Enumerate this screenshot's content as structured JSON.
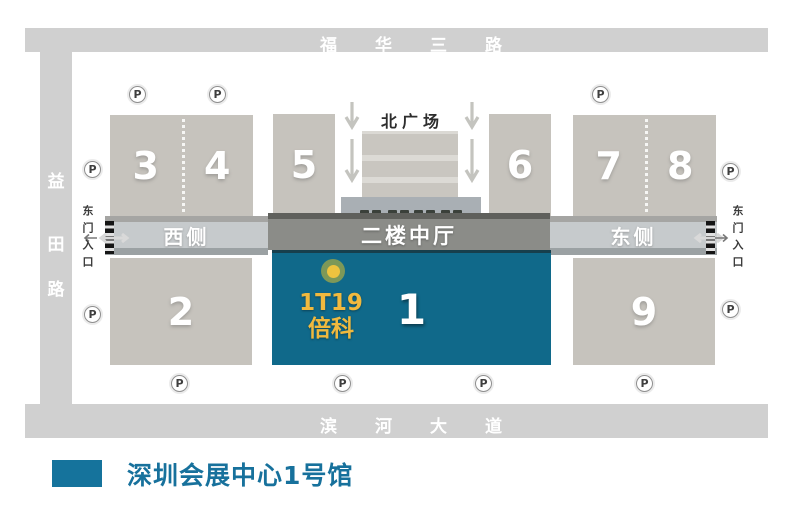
{
  "roads": {
    "top": {
      "label": "福华三路"
    },
    "left": {
      "c1": "益",
      "c2": "田",
      "c3": "路"
    },
    "bottom": {
      "label": "滨河大道"
    }
  },
  "plaza": {
    "label": "北广场"
  },
  "band": {
    "west": "西侧",
    "center": "二楼中厅",
    "east": "东侧"
  },
  "entrances": {
    "left": "东门入口",
    "right": "东门入口"
  },
  "halls": {
    "h1": "1",
    "h2": "2",
    "h3": "3",
    "h4": "4",
    "h5": "5",
    "h6": "6",
    "h7": "7",
    "h8": "8",
    "h9": "9"
  },
  "booth": {
    "code": "1T19",
    "name": "倍科"
  },
  "parking": {
    "label": "P"
  },
  "legend": {
    "label": "深圳会展中心1号馆",
    "swatch_color": "#15739c"
  },
  "colors": {
    "road_gray": "#d0d0d0",
    "hall_gray": "#c6c3bd",
    "hall1_teal": "#10698a",
    "band_light": "#c6cacc",
    "band_dark": "#8b8c88",
    "marker_yellow": "#eec33f",
    "marker_ring": "#7d9858",
    "booth_text": "#f0b93e",
    "legend_teal": "#15739c"
  }
}
